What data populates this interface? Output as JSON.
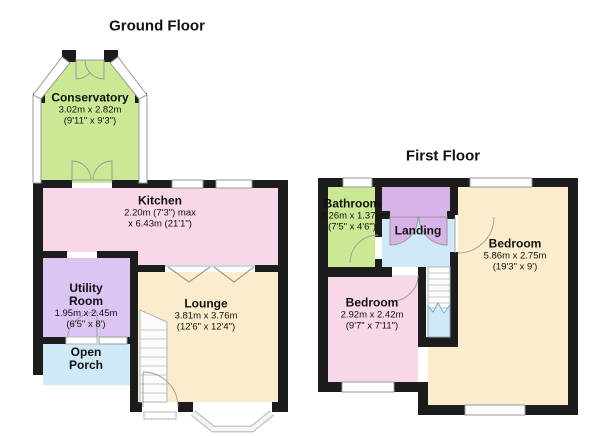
{
  "colors": {
    "wall": "#1c1c1c",
    "green": "#cbe995",
    "pink": "#f8d7e8",
    "purple": "#dbc5f2",
    "landing_purple": "#d8b3ea",
    "blue": "#cfe9f8",
    "beige": "#fbeccd",
    "window": "#ffffff"
  },
  "ground_floor": {
    "title": "Ground Floor",
    "rooms": {
      "conservatory": {
        "name": "Conservatory",
        "line1": "3.02m x 2.82m",
        "line2": "(9'11\" x 9'3\")"
      },
      "kitchen": {
        "name": "Kitchen",
        "line1": "2.20m (7'3\") max",
        "line2": "x 6.43m (21'1\")"
      },
      "utility": {
        "name": "Utility",
        "name2": "Room",
        "line1": "1.95m x 2.45m",
        "line2": "(6'5\" x 8')"
      },
      "porch": {
        "name": "Open",
        "name2": "Porch"
      },
      "lounge": {
        "name": "Lounge",
        "line1": "3.81m x 3.76m",
        "line2": "(12'6\" x 12'4\")"
      }
    }
  },
  "first_floor": {
    "title": "First Floor",
    "rooms": {
      "bathroom": {
        "name": "Bathroom",
        "line1": "2.26m x 1.37m",
        "line2": "(7'5\" x 4'6\")"
      },
      "landing": {
        "name": "Landing"
      },
      "bedroom1": {
        "name": "Bedroom",
        "line1": "5.86m x 2.75m",
        "line2": "(19'3\" x 9')"
      },
      "bedroom2": {
        "name": "Bedroom",
        "line1": "2.92m x 2.42m",
        "line2": "(9'7\" x 7'11\")"
      }
    }
  }
}
